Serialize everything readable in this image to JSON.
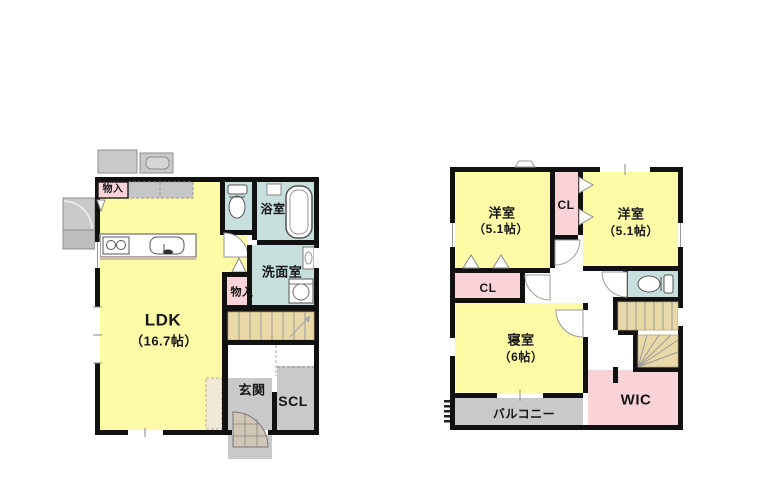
{
  "colors": {
    "room_yellow": "#fdfba6",
    "room_teal": "#c7e0de",
    "room_pink": "#fad3d8",
    "stairs_tan": "#ead9a8",
    "exterior_gray": "#c9c9c9",
    "wall": "#111111"
  },
  "floor1": {
    "rooms": {
      "storage1": "物入",
      "bath": "浴室",
      "washroom": "洗面室",
      "storage2": "物入",
      "ldk": "LDK",
      "ldk_size": "（16.7帖）",
      "entrance": "玄関",
      "scl": "SCL"
    }
  },
  "floor2": {
    "rooms": {
      "western_left": "洋室",
      "western_left_size": "（5.1帖）",
      "closet_center": "CL",
      "western_right": "洋室",
      "western_right_size": "（5.1帖）",
      "closet_lower": "CL",
      "bedroom": "寝室",
      "bedroom_size": "（6帖）",
      "wic": "WIC",
      "balcony": "バルコニー"
    }
  }
}
